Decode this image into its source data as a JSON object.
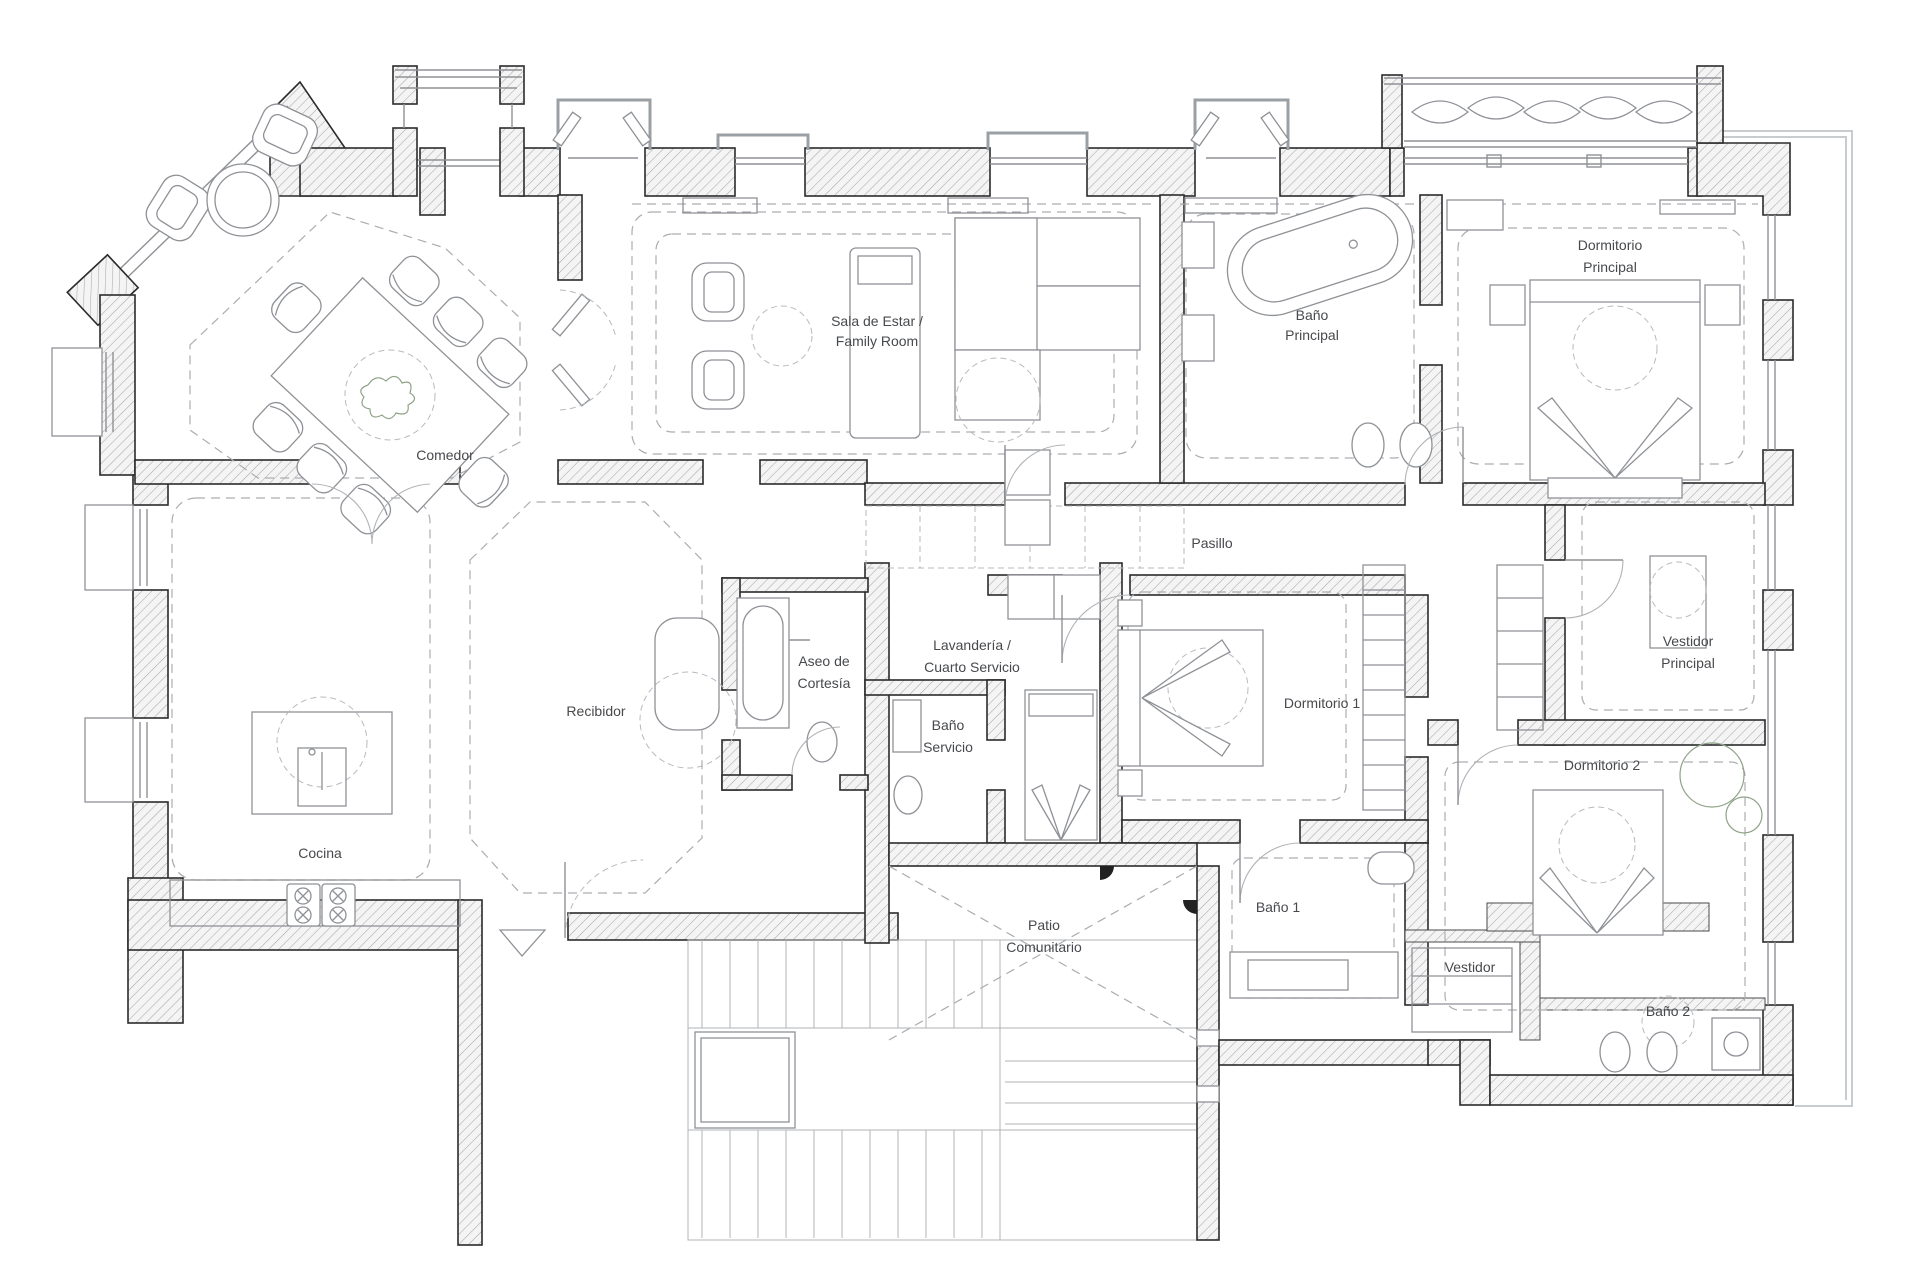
{
  "plan_title": "Floor plan",
  "rooms": {
    "comedor": {
      "label": "Comedor"
    },
    "sala": {
      "line1": "Sala de Estar /",
      "line2": "Family Room"
    },
    "banoPrincipal": {
      "line1": "Baño",
      "line2": "Principal"
    },
    "dormitorioPrincipal": {
      "line1": "Dormitorio",
      "line2": "Principal"
    },
    "pasillo": {
      "label": "Pasillo"
    },
    "lavanderia": {
      "line1": "Lavandería /",
      "line2": "Cuarto Servicio"
    },
    "aseo": {
      "line1": "Aseo de",
      "line2": "Cortesía"
    },
    "recibidor": {
      "label": "Recibidor"
    },
    "banoServicio": {
      "line1": "Baño",
      "line2": "Servicio"
    },
    "cocina": {
      "label": "Cocina"
    },
    "dormitorio1": {
      "label": "Dormitorio 1"
    },
    "vestidorPrincipal": {
      "line1": "Vestidor",
      "line2": "Principal"
    },
    "dormitorio2": {
      "label": "Dormitorio 2"
    },
    "bano1": {
      "label": "Baño 1"
    },
    "patio": {
      "line1": "Patio",
      "line2": "Comunitario"
    },
    "vestidor": {
      "label": "Vestidor"
    },
    "bano2": {
      "label": "Baño 2"
    }
  },
  "colors": {
    "wall_outline": "#2b2b2b",
    "hatch_line": "#a9a9a9",
    "furniture": "#8e9196",
    "dashed": "#aaadb0",
    "label": "#47494c",
    "plant": "#8fa287"
  }
}
